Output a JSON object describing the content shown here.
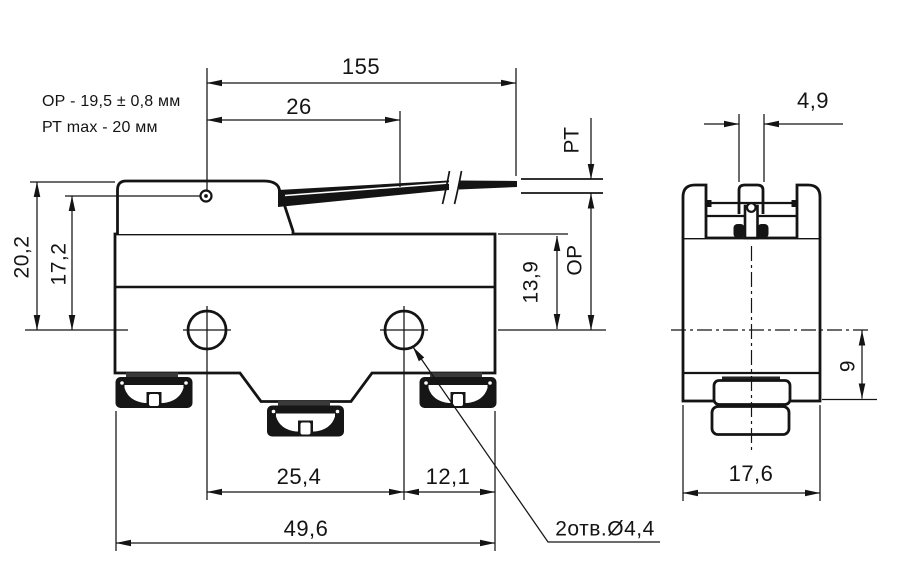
{
  "drawing": {
    "notes": {
      "op_spec": "ОР - 19,5 ± 0,8 мм",
      "pt_spec": "РТ max - 20 мм"
    },
    "front_view": {
      "dim_lever_total": "155",
      "dim_pivot_offset": "26",
      "dim_height_total": "20,2",
      "dim_pivot_height": "17,2",
      "label_pretravel": "РТ",
      "label_operating_pos": "ОР",
      "dim_top_to_hole_axis": "13,9",
      "dim_hole_spacing": "25,4",
      "dim_hole_to_edge": "12,1",
      "dim_body_width": "49,6",
      "note_holes": "2отв.Ø4,4"
    },
    "side_view": {
      "dim_plunger_width": "4,9",
      "dim_hole_axis_to_bottom": "9",
      "dim_body_depth": "17,6"
    },
    "colors": {
      "ink": "#141414",
      "terminal_fill": "#161616",
      "terminal_cap": "#3a3a3a",
      "background": "#ffffff"
    }
  }
}
